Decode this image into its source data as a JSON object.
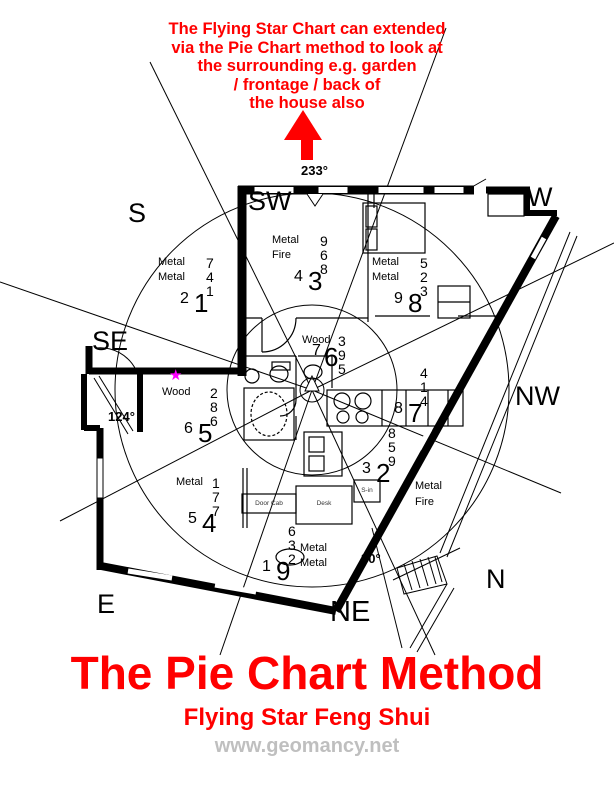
{
  "annotation": {
    "lines": [
      "The Flying Star Chart can extended",
      "via the Pie Chart method to look at",
      "the surrounding e.g. garden",
      "/ frontage / back of",
      "the house also"
    ]
  },
  "compass": {
    "s": "S",
    "sw": "SW",
    "w": "W",
    "se": "SE",
    "nw": "NW",
    "e": "E",
    "ne": "NE",
    "n": "N"
  },
  "angles": {
    "facing": "233°",
    "entrance": "124°",
    "gate": "30°"
  },
  "marker": {
    "star": "★"
  },
  "sectors": [
    {
      "name": "south",
      "el1": "Metal",
      "el2": "Metal",
      "stk": [
        "7",
        "4",
        "1"
      ],
      "med": "2",
      "big": "1"
    },
    {
      "name": "southwest",
      "el1": "Metal",
      "el2": "Fire",
      "stk": [
        "9",
        "6",
        "8"
      ],
      "med": "4",
      "big": "3"
    },
    {
      "name": "west",
      "el1": "Metal",
      "el2": "Metal",
      "stk": [
        "5",
        "2",
        "3"
      ],
      "med": "9",
      "big": "8"
    },
    {
      "name": "center",
      "el1": "Wood",
      "el2": "",
      "stk": [
        "3",
        "9",
        "5"
      ],
      "med": "7",
      "big": "6"
    },
    {
      "name": "northwest",
      "el1": "",
      "el2": "",
      "stk": [
        "4",
        "1",
        "4"
      ],
      "med": "8",
      "big": "7"
    },
    {
      "name": "southeast",
      "el1": "Wood",
      "el2": "",
      "stk": [
        "2",
        "8",
        "6"
      ],
      "med": "6",
      "big": "5"
    },
    {
      "name": "east",
      "el1": "Metal",
      "el2": "",
      "stk": [
        "1",
        "7",
        "7"
      ],
      "med": "5",
      "big": "4"
    },
    {
      "name": "northeast",
      "el1": "Metal",
      "el2": "Metal",
      "stk": [
        "6",
        "3",
        "2"
      ],
      "med": "1",
      "big": "9"
    },
    {
      "name": "north",
      "el1": "Metal",
      "el2": "Fire",
      "stk": [
        "8",
        "5",
        "9"
      ],
      "med": "3",
      "big": "2"
    }
  ],
  "furniture": {
    "desk": "Desk",
    "cabinet": "Door Cab",
    "shoe": "S-in"
  },
  "titles": {
    "main": "The Pie Chart Method",
    "subtitle": "Flying Star Feng Shui",
    "website": "www.geomancy.net"
  },
  "colors": {
    "accent": "#FF0000",
    "star": "#FF00FF",
    "watermark": "#BFBFBF"
  }
}
